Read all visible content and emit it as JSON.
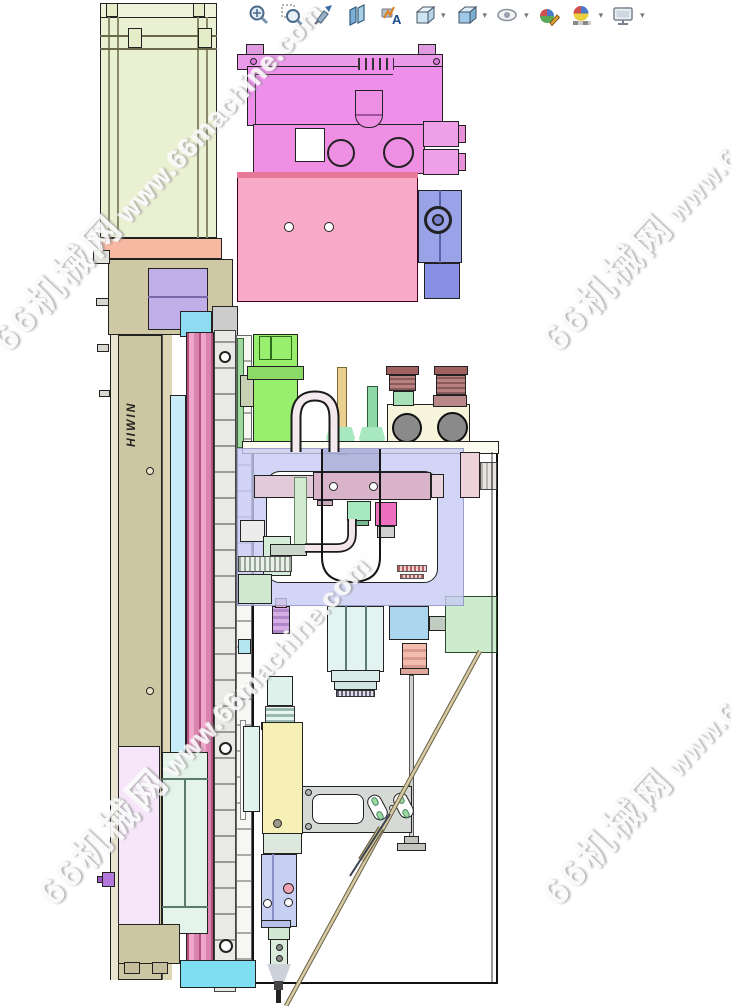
{
  "window": {
    "width": 731,
    "height": 1006,
    "background": "#ffffff"
  },
  "toolbar": {
    "caret_glyph": "▾",
    "annotation_letter": "A",
    "items": [
      {
        "name": "zoom-to-fit-icon",
        "title": "Zoom to Fit"
      },
      {
        "name": "zoom-to-area-icon",
        "title": "Zoom to Area"
      },
      {
        "name": "previous-view-icon",
        "title": "Previous View"
      },
      {
        "name": "section-view-icon",
        "title": "Section View"
      },
      {
        "name": "annotation-views-icon",
        "title": "Dynamic Annotation Views"
      },
      {
        "name": "view-orientation-icon",
        "title": "View Orientation",
        "has_dropdown": true
      },
      {
        "name": "display-style-icon",
        "title": "Display Style",
        "has_dropdown": true
      },
      {
        "name": "hide-show-items-icon",
        "title": "Hide/Show Items",
        "has_dropdown": true
      },
      {
        "name": "edit-appearance-icon",
        "title": "Edit Appearance"
      },
      {
        "name": "apply-scene-icon",
        "title": "Apply Scene",
        "has_dropdown": true
      },
      {
        "name": "view-settings-icon",
        "title": "View Settings",
        "has_dropdown": true
      }
    ]
  },
  "watermark": {
    "site_name": "66机械网",
    "site_url": "www.66machine.com"
  },
  "model": {
    "rail_brand_label": "HIWIN"
  },
  "colors": {
    "motor_body": "#eaf0d2",
    "salmon_plate": "#f7b9a2",
    "housing_tan": "#cfc8a4",
    "coupling_purple": "#c0aee8",
    "cyan_block": "#8fdcf2",
    "ballscrew_pink": "#f0a6ca",
    "violet_block": "#ee8fec",
    "pink_plate": "#f8aac6",
    "valve_blue": "#9aa2e8",
    "green_cylinder": "#97ef6d",
    "cream_manifold": "#f6f5dc",
    "fitting_brown": "#b98080",
    "selection_lavender": "#c9cdf0",
    "cyan_cylinder": "#e3f4f0",
    "blue_square": "#abd6ee",
    "green_bracket": "#cdeccd",
    "yellow_valve": "#f6efb6",
    "slide_periwinkle": "#c7cff2",
    "panel_pink": "#f7e6fa",
    "base_tan": "#cdc6a2",
    "bottom_cyan": "#7fdef2"
  }
}
